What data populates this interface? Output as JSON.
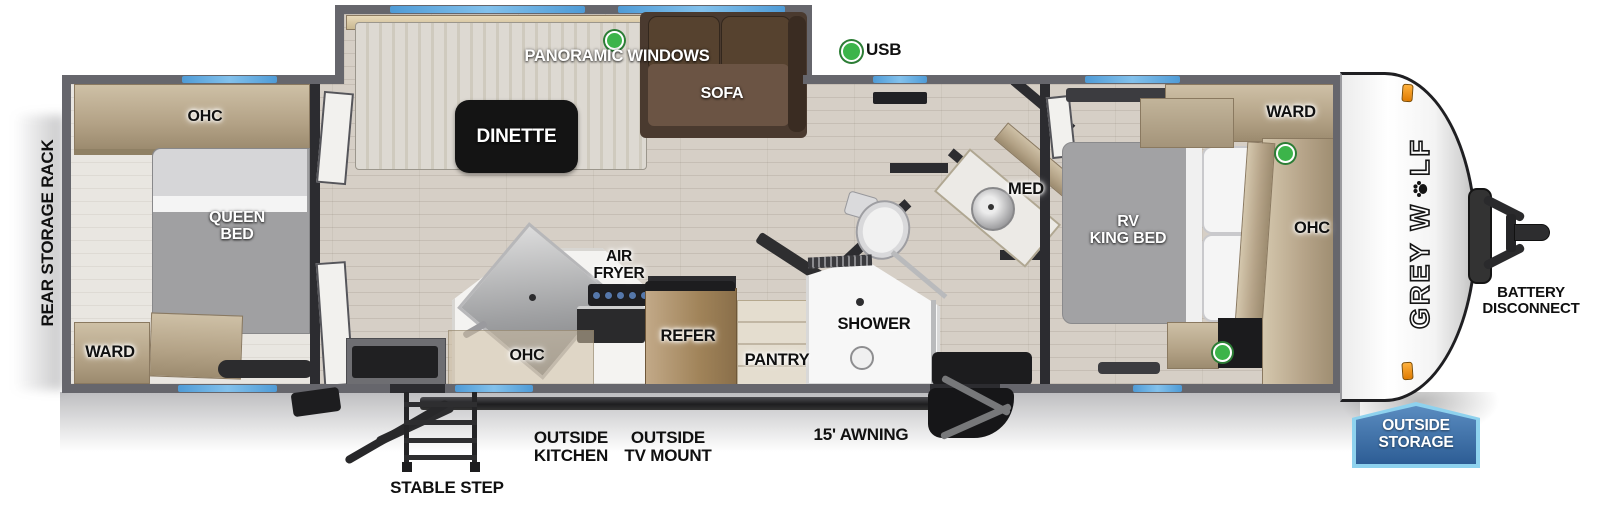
{
  "labels": {
    "rear_storage_rack": "REAR STORAGE RACK",
    "rear_ohc": "OHC",
    "queen_bed": "QUEEN\nBED",
    "rear_ward": "WARD",
    "panoramic_windows": "PANORAMIC WINDOWS",
    "dinette": "DINETTE",
    "sofa": "SOFA",
    "usb": "USB",
    "air_fryer": "AIR\nFRYER",
    "kitchen_ohc": "OHC",
    "refer": "REFER",
    "pantry": "PANTRY",
    "shower": "SHOWER",
    "med": "MED",
    "front_ward": "WARD",
    "rv_king_bed": "RV\nKING BED",
    "front_ohc": "OHC",
    "battery_disconnect": "BATTERY\nDISCONNECT",
    "outside_storage": "OUTSIDE\nSTORAGE",
    "stable_step": "STABLE STEP",
    "outside_kitchen": "OUTSIDE\nKITCHEN",
    "outside_tv_mount": "OUTSIDE\nTV MOUNT",
    "awning": "15' AWNING"
  },
  "brand": {
    "prefix": "GREY W",
    "suffix": "LF"
  },
  "colors": {
    "window_blue": "#57a4dd",
    "usb_green": "#3cb44a",
    "wall_gray": "#66666c",
    "badge_blue_dark": "#2d5d95",
    "badge_blue_light": "#5a8cc0",
    "badge_border": "#8ed2ee",
    "marker_orange": "#f09a1c"
  }
}
